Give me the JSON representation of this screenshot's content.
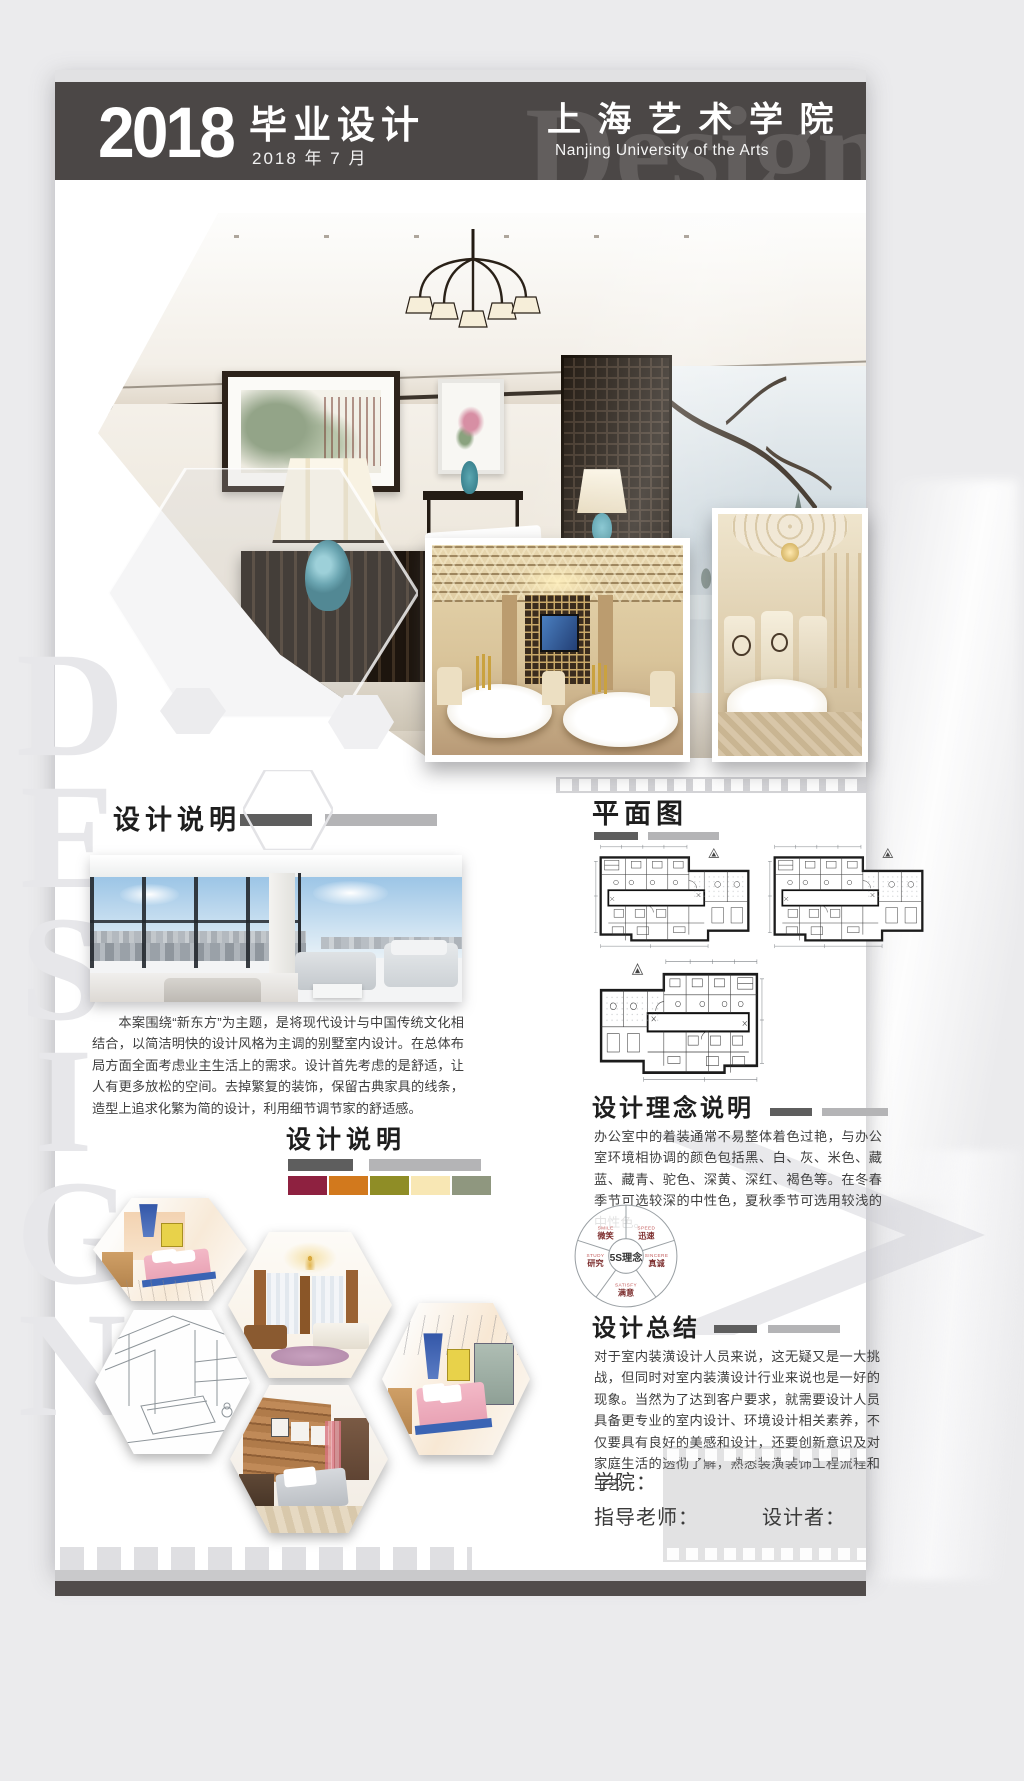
{
  "header": {
    "year": "2018",
    "title": "毕业设计",
    "date": "2018 年 7 月",
    "school_cn": "上 海 艺 术 学 院",
    "school_en": "Nanjing University of the Arts",
    "ghost_text": "Design"
  },
  "side_ghost": {
    "l1": "D",
    "l2": "E",
    "l3": "S",
    "l4": "I",
    "l5": "G",
    "l6": "N"
  },
  "sections": {
    "desc1": {
      "heading": "设计说明",
      "paragraph": "本案围绕“新东方”为主题，是将现代设计与中国传统文化相结合，以简洁明快的设计风格为主调的别墅室内设计。在总体布局方面全面考虑业主生活上的需求。设计首先考虑的是舒适，让人有更多放松的空间。去掉繁复的装饰，保留古典家具的线条，造型上追求化繁为简的设计，利用细节调节家的舒适感。"
    },
    "desc2": {
      "heading": "设计说明",
      "swatches": [
        "#8e2140",
        "#d2791d",
        "#8f8d26",
        "#f8e7b4",
        "#8f977f"
      ]
    },
    "plan": {
      "heading": "平面图"
    },
    "concept": {
      "heading": "设计理念说明",
      "paragraph": "办公室中的着装通常不易整体着色过艳，与办公室环境相协调的颜色包括黑、白、灰、米色、藏蓝、藏青、驼色、深黄、深红、褐色等。在冬春季节可选较深的中性色，夏秋季节可选用较浅的中性色。"
    },
    "five_s": {
      "center": "5S理念",
      "items": [
        {
          "en": "SMILE",
          "cn": "微笑"
        },
        {
          "en": "SPEED",
          "cn": "迅速"
        },
        {
          "en": "SINCERE",
          "cn": "真诚"
        },
        {
          "en": "SATISFY",
          "cn": "满意"
        },
        {
          "en": "STUDY",
          "cn": "研究"
        }
      ]
    },
    "summary": {
      "heading": "设计总结",
      "paragraph": "对于室内装潢设计人员来说，这无疑又是一大挑战，但同时对室内装潢设计行业来说也是一好的现象。当然为了达到客户要求，就需要设计人员具备更专业的室内设计、环境设计相关素养，不仅要具有良好的美感和设计，还要创新意识及对家庭生活的透彻了解，熟悉装潢装饰工程流程和工艺。"
    }
  },
  "footer": {
    "school_label": "学院：",
    "advisor_label": "指导老师：",
    "designer_label": "设计者："
  }
}
